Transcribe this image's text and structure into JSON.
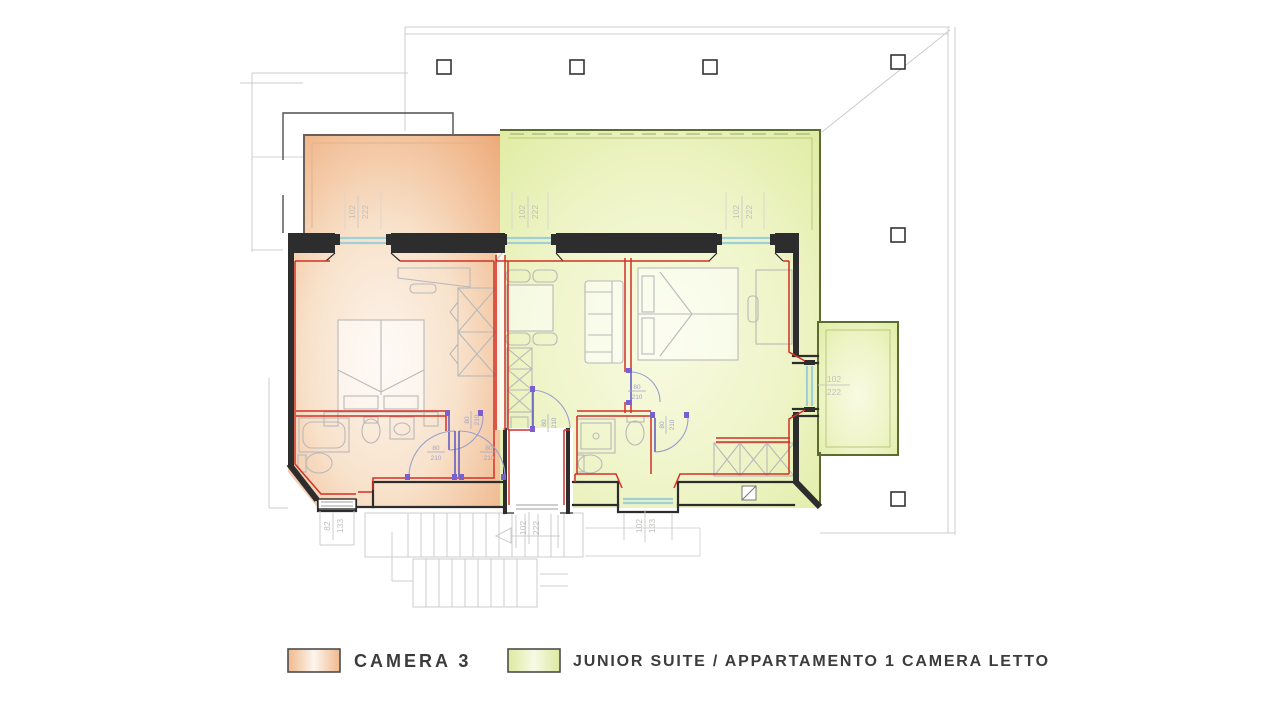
{
  "legend": {
    "items": [
      {
        "label": "CAMERA 3",
        "color_edge": "#efad7c",
        "color_center": "#fdf4ec"
      },
      {
        "label": "JUNIOR SUITE / APPARTAMENTO 1 CAMERA LETTO",
        "color_edge": "#dcea9b",
        "color_center": "#f7fade"
      }
    ]
  },
  "colors": {
    "wall-red": "#d23127",
    "wall-dark": "#2d2d2d",
    "sill-cyan": "#9fd0d6",
    "door-purple": "#7a5fd0",
    "outline-gray": "#cccccc",
    "camera3-edge": "#efad7c",
    "camera3-center": "#fdf4ec",
    "suite-edge": "#dcea9b",
    "suite-center": "#f7fade"
  },
  "plan": {
    "window_dimensions": [
      {
        "location": "camera3-top-window",
        "w": "102",
        "h": "222"
      },
      {
        "location": "suite-top-window-1",
        "w": "102",
        "h": "222"
      },
      {
        "location": "suite-top-window-2",
        "w": "102",
        "h": "222"
      },
      {
        "location": "suite-balcony-door",
        "w": "102",
        "h": "222"
      },
      {
        "location": "camera3-bottom-window",
        "w": "82",
        "h": "133"
      },
      {
        "location": "stairwell-window",
        "w": "102",
        "h": "222"
      },
      {
        "location": "suite-bottom-window",
        "w": "102",
        "h": "133"
      }
    ],
    "door_dimensions": [
      {
        "location": "camera3-bathroom-door",
        "w": "80",
        "h": "210"
      },
      {
        "location": "camera3-hall-door-1",
        "w": "80",
        "h": "210"
      },
      {
        "location": "camera3-hall-door-2",
        "w": "80",
        "h": "210"
      },
      {
        "location": "suite-entry-door",
        "w": "80",
        "h": "210"
      },
      {
        "location": "suite-bedroom-door",
        "w": "80",
        "h": "210"
      },
      {
        "location": "suite-bathroom-door",
        "w": "80",
        "h": "210"
      }
    ]
  }
}
